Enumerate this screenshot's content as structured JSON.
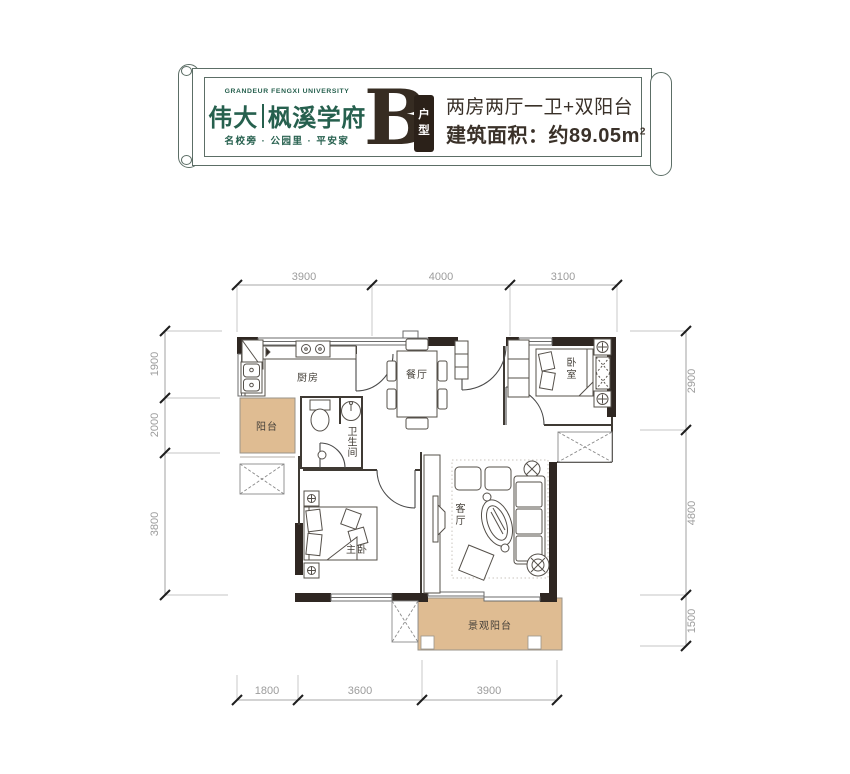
{
  "header": {
    "brand_en": "GRANDEUR FENGXI UNIVERSITY",
    "brand_cn": "伟大",
    "brand_sub": "枫溪学府",
    "tagline": "名校旁 · 公园里 · 平安家",
    "unit_letter": "B",
    "unit_type": {
      "c1": "户",
      "c2": "型"
    },
    "desc": "两房两厅一卫+双阳台",
    "area_prefix": "建筑面积：约89.05",
    "area_unit": "m",
    "area_sup": "2"
  },
  "plan": {
    "rooms": {
      "kitchen": "厨房",
      "dining": "餐厅",
      "bedroom": {
        "c1": "卧",
        "c2": "室"
      },
      "balcony": "阳台",
      "bath": {
        "c1": "卫",
        "c2": "生",
        "c3": "间"
      },
      "master": "主卧",
      "living": {
        "c1": "客",
        "c2": "厅"
      },
      "view_balcony": "景观阳台"
    },
    "dims": {
      "top": [
        "3900",
        "4000",
        "3100"
      ],
      "left": [
        "1900",
        "2000",
        "3800"
      ],
      "right": [
        "2900",
        "4800",
        "1500"
      ],
      "bottom": [
        "1800",
        "3600",
        "3900"
      ]
    }
  },
  "colors": {
    "brand_green": "#26604E",
    "badge_dark": "#2B2119",
    "wall": "#2F2722",
    "balcony_fill": "#DFBC92",
    "dim_text": "#9C9C9C"
  }
}
